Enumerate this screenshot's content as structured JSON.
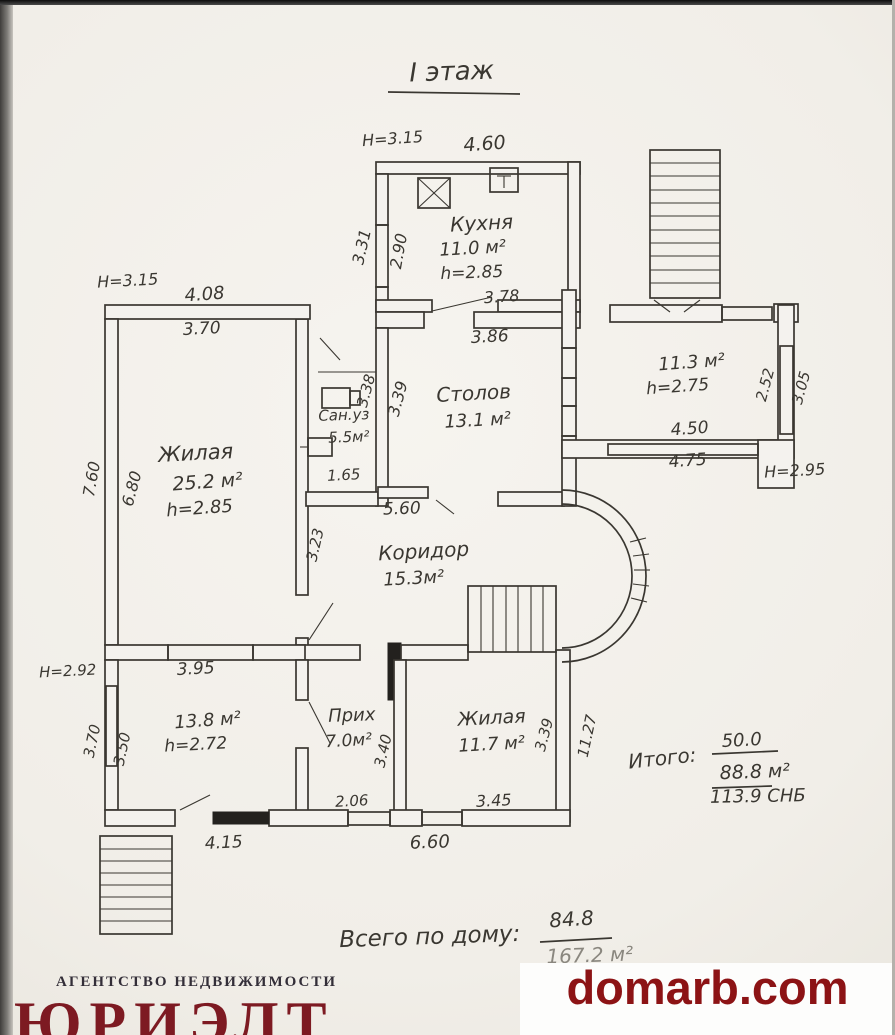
{
  "colors": {
    "ink": "#3a3731",
    "watermark_red": "#8c1315",
    "logo_red": "#7d1a22"
  },
  "title": "I этаж",
  "rooms": {
    "kitchen": {
      "name": "Кухня",
      "area": "11.0 м²",
      "height": "h=2.85"
    },
    "dining": {
      "name": "Столов",
      "area": "13.1 м²"
    },
    "living": {
      "name": "Жилая",
      "area": "25.2 м²",
      "height": "h=2.85"
    },
    "sanuz": {
      "name": "Сан.уз",
      "area": "5.5м²"
    },
    "corridor": {
      "name": "Коридор",
      "area": "15.3м²"
    },
    "veranda": {
      "area": "11.3 м²",
      "height": "h=2.75"
    },
    "room138": {
      "area": "13.8 м²",
      "height": "h=2.72"
    },
    "hall": {
      "name": "Прих",
      "area": "7.0м²"
    },
    "bedroom": {
      "name": "Жилая",
      "area": "11.7 м²"
    }
  },
  "dims": {
    "kitchen_h": "H=3.15",
    "kitchen_top": "4.60",
    "kitchen_left_out": "3.31",
    "kitchen_left_in": "2.90",
    "kitchen_bottom": "3.78",
    "dining_top": "3.86",
    "dining_left": "3.39",
    "sanuz_v": "3.38",
    "sanuz_bottom": "1.65",
    "main_h": "H=3.15",
    "main_top": "4.08",
    "living_top": "3.70",
    "left_out": "7.60",
    "left_in": "6.80",
    "corridor_top": "5.60",
    "corridor_left": "3.23",
    "veranda_win_in": "2.52",
    "veranda_win_out": "3.05",
    "veranda_bottom_in": "4.50",
    "veranda_bottom_out": "4.75",
    "veranda_h": "H=2.95",
    "lower_h": "H=2.92",
    "mid_wall": "3.95",
    "lower_left_out": "3.70",
    "lower_left_in": "3.50",
    "lower_bottom": "4.15",
    "hall_bottom": "2.06",
    "hall_v": "3.40",
    "bedroom_bottom": "3.45",
    "bedroom_right": "3.39",
    "right_out": "11.27",
    "bottom_total": "6.60"
  },
  "totals": {
    "label": "Итого:",
    "numerator": "50.0",
    "denominator": "88.8 м²",
    "snb": "113.9 СНБ"
  },
  "house": {
    "label": "Всего по дому:",
    "numerator": "84.8",
    "denominator": "167.2 м²"
  },
  "watermark": "domarb.com",
  "agency": {
    "tagline": "АГЕНТСТВО НЕДВИЖИМОСТИ",
    "name": "ЮРИЭЛТ"
  }
}
